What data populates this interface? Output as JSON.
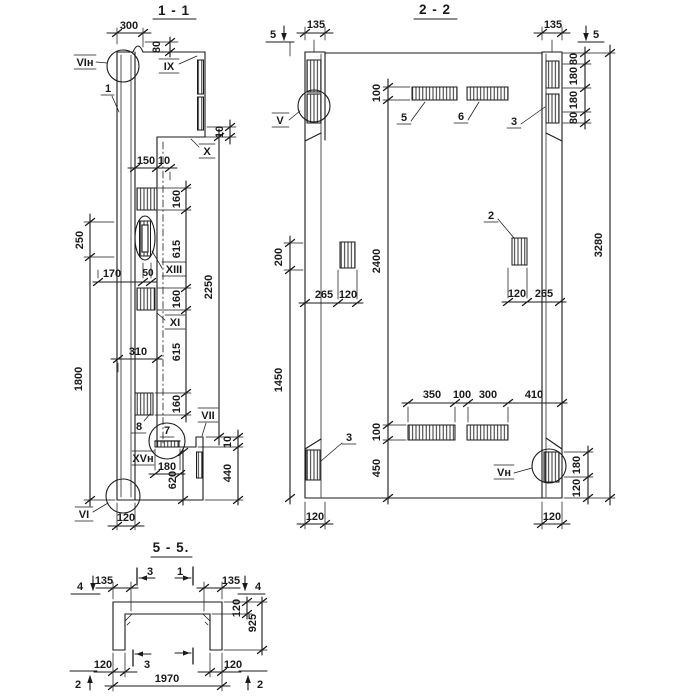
{
  "meta": {
    "background": "#ffffff",
    "ink": "#1a1a1a",
    "drawing_type": "structural section drawing"
  },
  "s11": {
    "title": "1 - 1",
    "dims": {
      "top_width": "300",
      "top_height": "80",
      "top_right_step": "10",
      "plate_width": "150",
      "plate_offset": "10",
      "sp1": "160",
      "sp2": "615",
      "sp3": "160",
      "sp4": "615",
      "sp5": "160",
      "overall_right": "2250",
      "left_upper": "250",
      "left_lower": "1800",
      "mid_width": "170",
      "mid_small": "50",
      "lower_width": "310",
      "angle_width": "180",
      "bottom_left_height": "620",
      "bottom_right_step": "10",
      "bottom_right_height": "440",
      "bottom_width": "120"
    },
    "labels": {
      "detail_vin": "VIн",
      "callout_1": "1",
      "detail_ix": "IX",
      "detail_x": "X",
      "detail_xiii": "XIII",
      "detail_xi": "XI",
      "callout_8": "8",
      "callout_7": "7",
      "detail_vii": "VII",
      "detail_xvn": "XVн",
      "detail_vi": "VI"
    }
  },
  "s22": {
    "title": "2 - 2",
    "markers": {
      "cut5_left": "5",
      "cut5_right": "5"
    },
    "dims": {
      "col_width_left": "135",
      "col_width_right": "135",
      "plate_height_top": "100",
      "r1": "80",
      "r2": "180",
      "r3": "180",
      "r4": "80",
      "overall_height": "3280",
      "left_upper": "200",
      "mid_height": "2400",
      "left_plate_offset": "265",
      "left_plate_width": "120",
      "right_plate_width": "120",
      "right_plate_offset": "265",
      "b1": "350",
      "b2": "100",
      "b3": "300",
      "b4": "410",
      "plate_height_bottom": "100",
      "bottom_height": "450",
      "left_lower": "1450",
      "r5": "180",
      "r6": "120",
      "bottom_left": "120",
      "bottom_right": "120"
    },
    "labels": {
      "detail_v": "V",
      "callout_5": "5",
      "callout_6": "6",
      "callout_3_top": "3",
      "callout_2": "2",
      "callout_3_bottom": "3",
      "detail_vn": "Vн"
    }
  },
  "s55": {
    "title": "5 - 5.",
    "markers": {
      "cut4_left": "4",
      "cut3_top": "3",
      "cut1_top": "1",
      "cut4_right": "4",
      "cut2_left": "2",
      "cut3_bottom": "3",
      "cut2_right": "2"
    },
    "dims": {
      "leg_top_left": "135",
      "leg_top_right": "135",
      "slab_thickness": "120",
      "section_height": "925",
      "leg_bottom_left": "120",
      "leg_bottom_right": "120",
      "overall_width": "1970"
    }
  }
}
